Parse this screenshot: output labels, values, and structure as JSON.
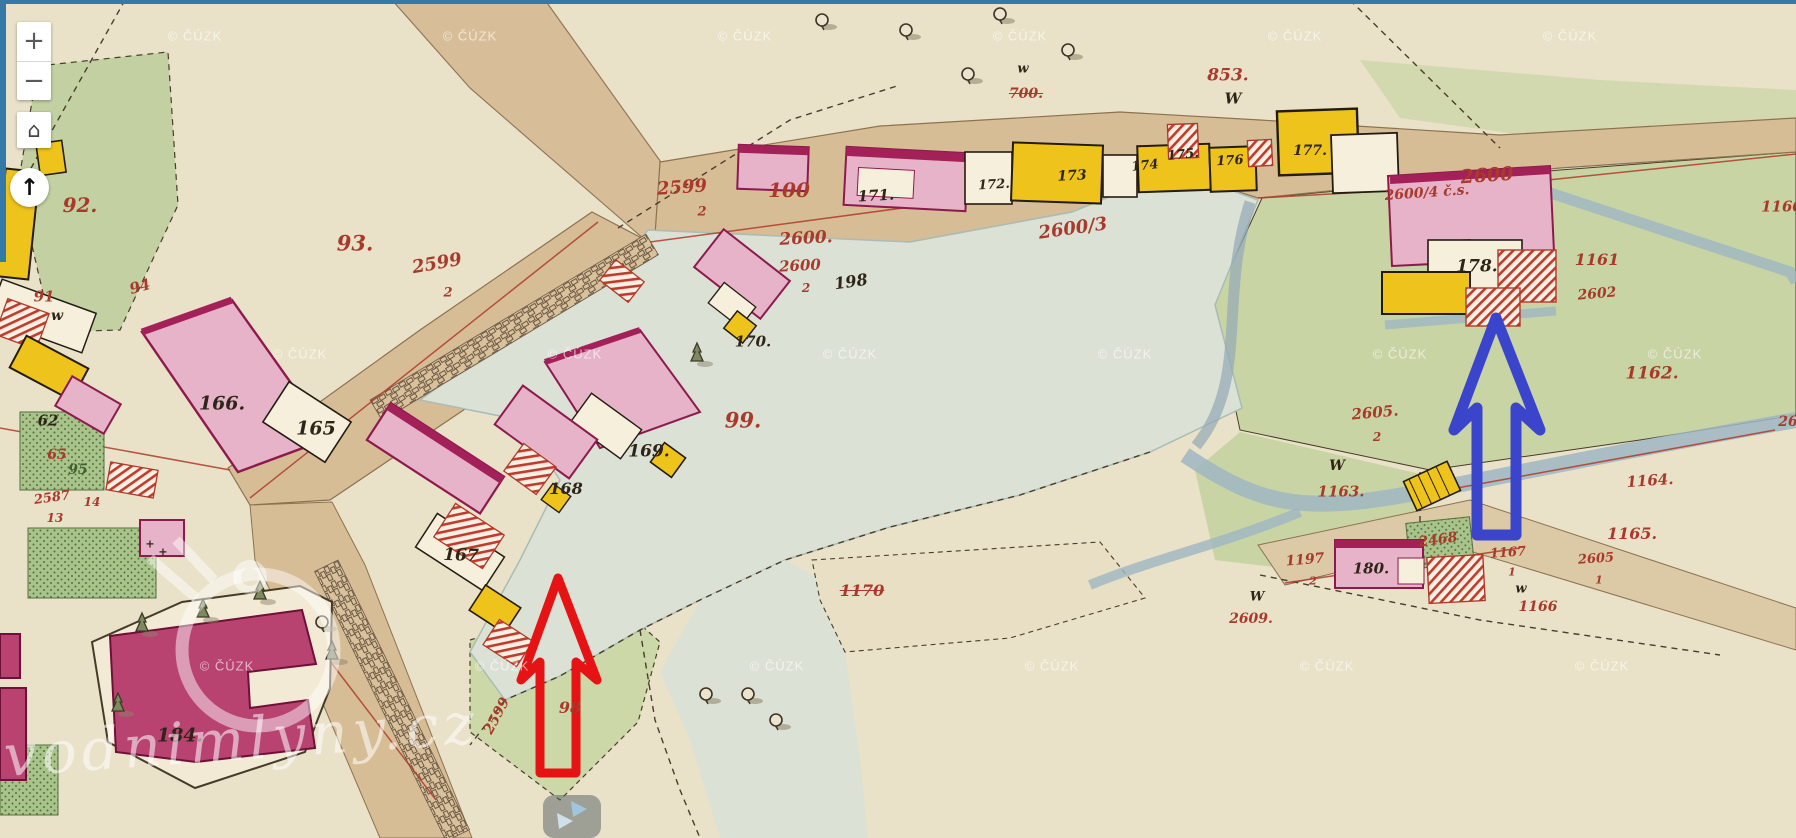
{
  "viewer": {
    "zoom_in": "+",
    "zoom_out": "−",
    "home_icon": "⌂",
    "north_icon": "↑",
    "border_color": "#3579a8"
  },
  "watermarks": {
    "cuzk": "© ČÚZK",
    "site": "vodnimlyny.cz",
    "cuzk_positions": [
      [
        195,
        36
      ],
      [
        470,
        36
      ],
      [
        745,
        36
      ],
      [
        1020,
        36
      ],
      [
        1295,
        36
      ],
      [
        1570,
        36
      ],
      [
        300,
        354
      ],
      [
        575,
        354
      ],
      [
        850,
        354
      ],
      [
        1125,
        354
      ],
      [
        1400,
        354
      ],
      [
        1675,
        354
      ],
      [
        227,
        666
      ],
      [
        502,
        666
      ],
      [
        777,
        666
      ],
      [
        1052,
        666
      ],
      [
        1327,
        666
      ],
      [
        1602,
        666
      ]
    ]
  },
  "annotations": {
    "red_arrow_color": "#e51313",
    "blue_arrow_color": "#3b45cb"
  },
  "map_labels": [
    {
      "t": "92.",
      "x": 80,
      "y": 205,
      "c": "red",
      "s": 20
    },
    {
      "t": "91",
      "x": 44,
      "y": 297,
      "c": "red",
      "s": 15
    },
    {
      "t": "w",
      "x": 57,
      "y": 316,
      "c": "blk",
      "s": 14
    },
    {
      "t": "94",
      "x": 140,
      "y": 287,
      "c": "red",
      "s": 15,
      "r": -15
    },
    {
      "t": "93.",
      "x": 355,
      "y": 243,
      "c": "red",
      "s": 21
    },
    {
      "t": "166.",
      "x": 222,
      "y": 404,
      "c": "blk",
      "s": 19
    },
    {
      "t": "165",
      "x": 316,
      "y": 429,
      "c": "blk",
      "s": 19
    },
    {
      "t": "62",
      "x": 48,
      "y": 421,
      "c": "blk",
      "s": 15
    },
    {
      "t": "65",
      "x": 57,
      "y": 455,
      "c": "red",
      "s": 14
    },
    {
      "t": "95",
      "x": 78,
      "y": 470,
      "c": "grn",
      "s": 14
    },
    {
      "t": "2587",
      "x": 52,
      "y": 498,
      "c": "red",
      "s": 13,
      "r": -8
    },
    {
      "t": "14",
      "x": 92,
      "y": 502,
      "c": "red",
      "s": 12
    },
    {
      "t": "13",
      "x": 55,
      "y": 518,
      "c": "red",
      "s": 12
    },
    {
      "t": "184.",
      "x": 180,
      "y": 736,
      "c": "blk",
      "s": 19
    },
    {
      "t": "167",
      "x": 461,
      "y": 556,
      "c": "blk",
      "s": 17,
      "r": 2
    },
    {
      "t": "168",
      "x": 566,
      "y": 489,
      "c": "blk",
      "s": 16
    },
    {
      "t": "169.",
      "x": 649,
      "y": 452,
      "c": "blk",
      "s": 17
    },
    {
      "t": "170.",
      "x": 753,
      "y": 342,
      "c": "blk",
      "s": 15
    },
    {
      "t": "2599",
      "x": 682,
      "y": 188,
      "c": "red",
      "s": 18,
      "r": -4
    },
    {
      "t": "2",
      "x": 702,
      "y": 212,
      "c": "red",
      "s": 13
    },
    {
      "t": "2599",
      "x": 437,
      "y": 264,
      "c": "red",
      "s": 18,
      "r": -10
    },
    {
      "t": "2",
      "x": 448,
      "y": 293,
      "c": "red",
      "s": 13
    },
    {
      "t": "100",
      "x": 789,
      "y": 190,
      "c": "red",
      "s": 20
    },
    {
      "t": "2600.",
      "x": 806,
      "y": 239,
      "c": "red",
      "s": 17,
      "r": -3
    },
    {
      "t": "2600",
      "x": 800,
      "y": 266,
      "c": "red",
      "s": 15,
      "r": -3
    },
    {
      "t": "2",
      "x": 806,
      "y": 288,
      "c": "red",
      "s": 12
    },
    {
      "t": "198",
      "x": 851,
      "y": 282,
      "c": "blk",
      "s": 16,
      "r": -8
    },
    {
      "t": "2600/3",
      "x": 1073,
      "y": 229,
      "c": "red",
      "s": 18,
      "r": -8
    },
    {
      "t": "99.",
      "x": 743,
      "y": 420,
      "c": "red",
      "s": 21
    },
    {
      "t": "171.",
      "x": 876,
      "y": 196,
      "c": "blk",
      "s": 15,
      "r": -3
    },
    {
      "t": "172.",
      "x": 994,
      "y": 185,
      "c": "blk",
      "s": 13,
      "r": -3
    },
    {
      "t": "173",
      "x": 1072,
      "y": 176,
      "c": "blk",
      "s": 14,
      "r": -3
    },
    {
      "t": "174",
      "x": 1145,
      "y": 166,
      "c": "blk",
      "s": 13,
      "r": -6
    },
    {
      "t": "175.",
      "x": 1183,
      "y": 155,
      "c": "blk",
      "s": 13,
      "r": -6
    },
    {
      "t": "176",
      "x": 1230,
      "y": 161,
      "c": "blk",
      "s": 13,
      "r": -3
    },
    {
      "t": "177.",
      "x": 1310,
      "y": 151,
      "c": "blk",
      "s": 14
    },
    {
      "t": "853.",
      "x": 1228,
      "y": 76,
      "c": "red",
      "s": 17
    },
    {
      "t": "W",
      "x": 1233,
      "y": 99,
      "c": "blk",
      "s": 15
    },
    {
      "t": "700.",
      "x": 1026,
      "y": 94,
      "c": "red",
      "s": 14,
      "k": 1
    },
    {
      "t": "w",
      "x": 1023,
      "y": 69,
      "c": "blk",
      "s": 13
    },
    {
      "t": "2600",
      "x": 1487,
      "y": 176,
      "c": "red",
      "s": 19,
      "r": -4
    },
    {
      "t": "2600/4 č.s.",
      "x": 1427,
      "y": 193,
      "c": "red",
      "s": 14,
      "r": -4
    },
    {
      "t": "1160",
      "x": 1782,
      "y": 207,
      "c": "red",
      "s": 15
    },
    {
      "t": "178.",
      "x": 1477,
      "y": 267,
      "c": "blk",
      "s": 17
    },
    {
      "t": "1161",
      "x": 1597,
      "y": 260,
      "c": "red",
      "s": 16
    },
    {
      "t": "2602",
      "x": 1597,
      "y": 294,
      "c": "red",
      "s": 14,
      "r": -5
    },
    {
      "t": "1162.",
      "x": 1652,
      "y": 374,
      "c": "red",
      "s": 17
    },
    {
      "t": "2605.",
      "x": 1375,
      "y": 413,
      "c": "red",
      "s": 15,
      "r": -5
    },
    {
      "t": "2",
      "x": 1377,
      "y": 437,
      "c": "red",
      "s": 12
    },
    {
      "t": "W",
      "x": 1337,
      "y": 466,
      "c": "blk",
      "s": 14
    },
    {
      "t": "1163.",
      "x": 1341,
      "y": 492,
      "c": "red",
      "s": 15
    },
    {
      "t": "1164.",
      "x": 1650,
      "y": 481,
      "c": "red",
      "s": 15,
      "r": -4
    },
    {
      "t": "1165.",
      "x": 1632,
      "y": 534,
      "c": "red",
      "s": 16
    },
    {
      "t": "2468",
      "x": 1438,
      "y": 540,
      "c": "red",
      "s": 14,
      "r": -8
    },
    {
      "t": "1197",
      "x": 1305,
      "y": 560,
      "c": "red",
      "s": 14,
      "r": -5
    },
    {
      "t": "2",
      "x": 1313,
      "y": 581,
      "c": "red",
      "s": 11
    },
    {
      "t": "180.",
      "x": 1371,
      "y": 569,
      "c": "blk",
      "s": 15
    },
    {
      "t": "1167",
      "x": 1508,
      "y": 553,
      "c": "red",
      "s": 13,
      "r": -4
    },
    {
      "t": "1",
      "x": 1512,
      "y": 572,
      "c": "red",
      "s": 11
    },
    {
      "t": "2605",
      "x": 1596,
      "y": 559,
      "c": "red",
      "s": 13,
      "r": -4
    },
    {
      "t": "1",
      "x": 1599,
      "y": 580,
      "c": "red",
      "s": 11
    },
    {
      "t": "26",
      "x": 1788,
      "y": 422,
      "c": "red",
      "s": 14
    },
    {
      "t": "W",
      "x": 1257,
      "y": 597,
      "c": "blk",
      "s": 13
    },
    {
      "t": "2609.",
      "x": 1251,
      "y": 619,
      "c": "red",
      "s": 14
    },
    {
      "t": "1170",
      "x": 862,
      "y": 591,
      "c": "red",
      "s": 16,
      "k": 1
    },
    {
      "t": "w",
      "x": 1521,
      "y": 589,
      "c": "blk",
      "s": 13
    },
    {
      "t": "1166",
      "x": 1538,
      "y": 607,
      "c": "red",
      "s": 14
    },
    {
      "t": "98",
      "x": 570,
      "y": 708,
      "c": "red",
      "s": 16
    },
    {
      "t": "2599",
      "x": 497,
      "y": 716,
      "c": "red",
      "s": 14,
      "r": -62
    },
    {
      "t": "+",
      "x": 150,
      "y": 544,
      "c": "blk",
      "s": 11
    },
    {
      "t": "+",
      "x": 163,
      "y": 552,
      "c": "blk",
      "s": 11
    }
  ]
}
